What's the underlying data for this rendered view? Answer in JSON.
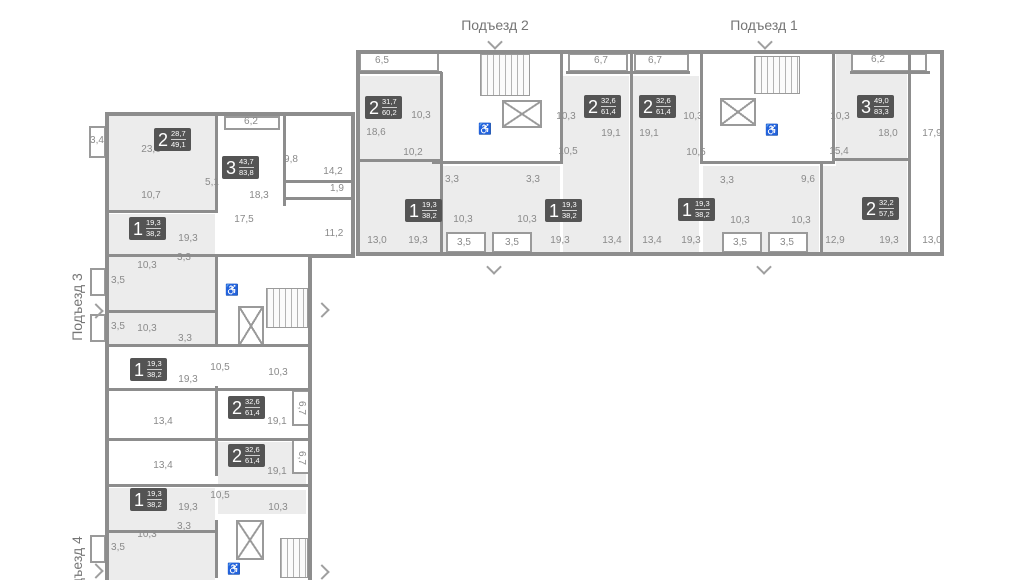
{
  "colors": {
    "wall": "#8d8d8d",
    "room_fill": "#ececec",
    "badge_bg": "#545454",
    "dim_text": "#8a8a8a",
    "section_text": "#757575"
  },
  "sections": {
    "s1": {
      "label": "Подъезд 1"
    },
    "s2": {
      "label": "Подъезд 2"
    },
    "s3": {
      "label": "Подъезд 3"
    },
    "s4": {
      "label": "Подъезд 4"
    }
  },
  "apartments": [
    {
      "rooms": "2",
      "living": "31,7",
      "total": "60,2",
      "x": 365,
      "y": 96
    },
    {
      "rooms": "2",
      "living": "32,6",
      "total": "61,4",
      "x": 584,
      "y": 95
    },
    {
      "rooms": "2",
      "living": "32,6",
      "total": "61,4",
      "x": 639,
      "y": 95
    },
    {
      "rooms": "3",
      "living": "49,0",
      "total": "83,3",
      "x": 857,
      "y": 95
    },
    {
      "rooms": "1",
      "living": "19,3",
      "total": "38,2",
      "x": 405,
      "y": 199
    },
    {
      "rooms": "1",
      "living": "19,3",
      "total": "38,2",
      "x": 545,
      "y": 199
    },
    {
      "rooms": "1",
      "living": "19,3",
      "total": "38,2",
      "x": 678,
      "y": 198
    },
    {
      "rooms": "2",
      "living": "32,2",
      "total": "57,5",
      "x": 862,
      "y": 197
    },
    {
      "rooms": "2",
      "living": "28,7",
      "total": "49,1",
      "x": 154,
      "y": 128
    },
    {
      "rooms": "3",
      "living": "43,7",
      "total": "83,8",
      "x": 222,
      "y": 156
    },
    {
      "rooms": "1",
      "living": "19,3",
      "total": "38,2",
      "x": 129,
      "y": 217
    },
    {
      "rooms": "1",
      "living": "19,3",
      "total": "38,2",
      "x": 130,
      "y": 358
    },
    {
      "rooms": "2",
      "living": "32,6",
      "total": "61,4",
      "x": 228,
      "y": 396
    },
    {
      "rooms": "2",
      "living": "32,6",
      "total": "61,4",
      "x": 228,
      "y": 444
    },
    {
      "rooms": "1",
      "living": "19,3",
      "total": "38,2",
      "x": 130,
      "y": 488
    }
  ],
  "dims": [
    [
      "6,5",
      382,
      61
    ],
    [
      "6,7",
      601,
      61
    ],
    [
      "6,7",
      655,
      61
    ],
    [
      "6,2",
      878,
      60
    ],
    [
      "10,3",
      421,
      116
    ],
    [
      "18,6",
      376,
      133
    ],
    [
      "10,2",
      413,
      153
    ],
    [
      "10,3",
      566,
      117
    ],
    [
      "19,1",
      611,
      134
    ],
    [
      "19,1",
      649,
      134
    ],
    [
      "10,5",
      568,
      152
    ],
    [
      "10,3",
      693,
      117
    ],
    [
      "10,5",
      696,
      153
    ],
    [
      "10,3",
      840,
      117
    ],
    [
      "18,0",
      888,
      134
    ],
    [
      "17,9",
      932,
      134
    ],
    [
      "15,4",
      839,
      152
    ],
    [
      "3,3",
      452,
      180
    ],
    [
      "3,3",
      533,
      180
    ],
    [
      "3,3",
      727,
      181
    ],
    [
      "9,6",
      808,
      180
    ],
    [
      "10,3",
      463,
      220
    ],
    [
      "10,3",
      527,
      220
    ],
    [
      "10,3",
      740,
      221
    ],
    [
      "10,3",
      801,
      221
    ],
    [
      "13,0",
      377,
      241
    ],
    [
      "19,3",
      418,
      241
    ],
    [
      "3,5",
      464,
      243
    ],
    [
      "3,5",
      512,
      243
    ],
    [
      "19,3",
      560,
      241
    ],
    [
      "13,4",
      612,
      241
    ],
    [
      "13,4",
      652,
      241
    ],
    [
      "19,3",
      691,
      241
    ],
    [
      "3,5",
      740,
      243
    ],
    [
      "3,5",
      787,
      243
    ],
    [
      "12,9",
      835,
      241
    ],
    [
      "19,3",
      889,
      241
    ],
    [
      "13,0",
      932,
      241
    ],
    [
      "3,4",
      97,
      141
    ],
    [
      "23,6",
      151,
      150
    ],
    [
      "6,2",
      251,
      122
    ],
    [
      "9,8",
      291,
      160
    ],
    [
      "14,2",
      333,
      172
    ],
    [
      "1,9",
      337,
      189
    ],
    [
      "5,1",
      212,
      183
    ],
    [
      "10,7",
      151,
      196
    ],
    [
      "18,3",
      259,
      196
    ],
    [
      "17,5",
      244,
      220
    ],
    [
      "11,2",
      334,
      234
    ],
    [
      "19,3",
      188,
      239
    ],
    [
      "3,3",
      184,
      258
    ],
    [
      "10,3",
      147,
      266
    ],
    [
      "3,5",
      118,
      281
    ],
    [
      "3,5",
      118,
      327
    ],
    [
      "10,3",
      147,
      329
    ],
    [
      "3,3",
      185,
      339
    ],
    [
      "19,3",
      188,
      380
    ],
    [
      "10,5",
      220,
      368
    ],
    [
      "10,3",
      278,
      373
    ],
    [
      "13,4",
      163,
      422
    ],
    [
      "19,1",
      277,
      422
    ],
    [
      "6,7",
      301,
      408,
      1
    ],
    [
      "13,4",
      163,
      466
    ],
    [
      "19,1",
      277,
      472
    ],
    [
      "6,7",
      301,
      458,
      1
    ],
    [
      "10,5",
      220,
      496
    ],
    [
      "19,3",
      188,
      508
    ],
    [
      "10,3",
      278,
      508
    ],
    [
      "3,3",
      184,
      527
    ],
    [
      "10,3",
      147,
      535
    ],
    [
      "3,5",
      118,
      548
    ]
  ],
  "plan": {
    "rooms_gray": [
      [
        360,
        76,
        80,
        176
      ],
      [
        402,
        166,
        158,
        86
      ],
      [
        563,
        76,
        66,
        176
      ],
      [
        633,
        76,
        66,
        176
      ],
      [
        703,
        166,
        116,
        86
      ],
      [
        836,
        54,
        71,
        198
      ],
      [
        822,
        166,
        85,
        86
      ],
      [
        109,
        116,
        106,
        94
      ],
      [
        109,
        214,
        106,
        96
      ],
      [
        109,
        312,
        106,
        32
      ],
      [
        218,
        442,
        88,
        44
      ],
      [
        109,
        488,
        106,
        92
      ],
      [
        218,
        490,
        88,
        24
      ]
    ],
    "balconies": [
      [
        359,
        52,
        80,
        20
      ],
      [
        568,
        53,
        60,
        19
      ],
      [
        634,
        53,
        55,
        19
      ],
      [
        851,
        53,
        76,
        19
      ],
      [
        446,
        232,
        40,
        21
      ],
      [
        492,
        232,
        40,
        21
      ],
      [
        722,
        232,
        40,
        21
      ],
      [
        768,
        232,
        40,
        21
      ],
      [
        89,
        126,
        17,
        32
      ],
      [
        90,
        268,
        16,
        28
      ],
      [
        90,
        314,
        16,
        28
      ],
      [
        90,
        535,
        16,
        28
      ],
      [
        224,
        116,
        56,
        14
      ],
      [
        292,
        390,
        18,
        36
      ],
      [
        292,
        438,
        18,
        36
      ]
    ],
    "stairs": [
      [
        480,
        54,
        50,
        42
      ],
      [
        754,
        56,
        46,
        38
      ],
      [
        266,
        288,
        42,
        40
      ],
      [
        280,
        538,
        28,
        40
      ]
    ],
    "elevators": [
      [
        502,
        100,
        40,
        28
      ],
      [
        720,
        98,
        36,
        28
      ],
      [
        238,
        306,
        26,
        40
      ],
      [
        236,
        520,
        28,
        40
      ]
    ],
    "wheelchair_icons": [
      [
        485,
        130
      ],
      [
        772,
        131
      ],
      [
        232,
        291
      ],
      [
        234,
        570
      ]
    ],
    "walls": [
      [
        356,
        50,
        588,
        4
      ],
      [
        356,
        252,
        588,
        4
      ],
      [
        356,
        50,
        4,
        206
      ],
      [
        940,
        50,
        4,
        206
      ],
      [
        440,
        72,
        3,
        182
      ],
      [
        560,
        50,
        3,
        114
      ],
      [
        630,
        50,
        3,
        204
      ],
      [
        700,
        50,
        3,
        114
      ],
      [
        832,
        50,
        3,
        114
      ],
      [
        908,
        52,
        3,
        202
      ],
      [
        820,
        164,
        3,
        90
      ],
      [
        432,
        161,
        130,
        3
      ],
      [
        700,
        161,
        133,
        3
      ],
      [
        358,
        159,
        84,
        3
      ],
      [
        834,
        158,
        76,
        3
      ],
      [
        358,
        71,
        84,
        3
      ],
      [
        566,
        71,
        66,
        3
      ],
      [
        632,
        71,
        58,
        3
      ],
      [
        850,
        71,
        80,
        3
      ],
      [
        105,
        112,
        250,
        4
      ],
      [
        105,
        112,
        4,
        468
      ],
      [
        351,
        112,
        4,
        146
      ],
      [
        308,
        254,
        4,
        326
      ],
      [
        308,
        254,
        47,
        4
      ],
      [
        215,
        112,
        3,
        100
      ],
      [
        215,
        254,
        3,
        90
      ],
      [
        215,
        386,
        3,
        90
      ],
      [
        215,
        520,
        3,
        58
      ],
      [
        283,
        112,
        3,
        94
      ],
      [
        285,
        180,
        68,
        3
      ],
      [
        285,
        197,
        68,
        3
      ],
      [
        105,
        210,
        113,
        3
      ],
      [
        105,
        254,
        250,
        3
      ],
      [
        105,
        310,
        113,
        3
      ],
      [
        105,
        344,
        206,
        3
      ],
      [
        105,
        388,
        206,
        3
      ],
      [
        105,
        438,
        206,
        3
      ],
      [
        105,
        484,
        206,
        3
      ],
      [
        105,
        530,
        113,
        3
      ]
    ],
    "chevrons": [
      [
        495,
        42,
        "down"
      ],
      [
        765,
        42,
        "down"
      ],
      [
        494,
        267,
        "down"
      ],
      [
        764,
        267,
        "down"
      ],
      [
        96,
        311,
        "right"
      ],
      [
        322,
        310,
        "right"
      ],
      [
        96,
        571,
        "right"
      ],
      [
        322,
        572,
        "right"
      ]
    ]
  },
  "section_positions": {
    "s2": {
      "x": 495,
      "y": 25
    },
    "s1": {
      "x": 764,
      "y": 25
    },
    "s3": {
      "x": 77,
      "y": 307
    },
    "s4": {
      "x": 77,
      "y": 570
    }
  }
}
